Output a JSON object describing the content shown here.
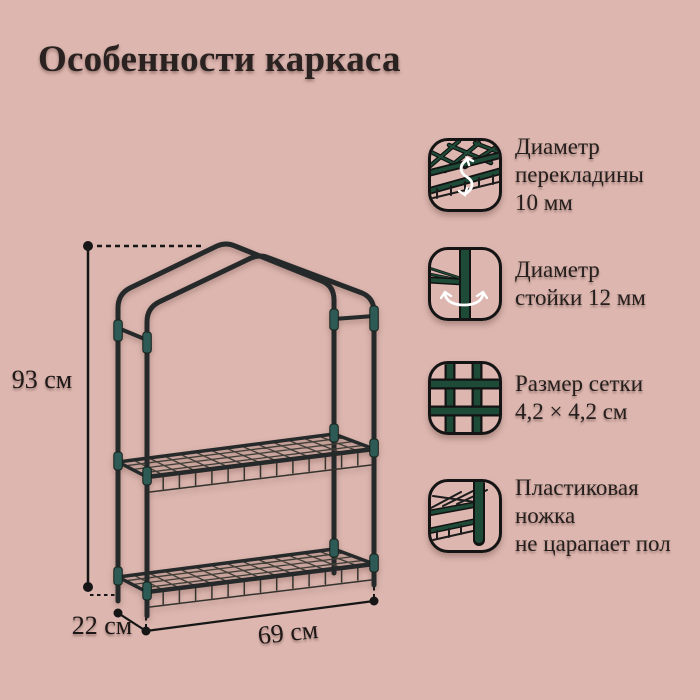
{
  "page": {
    "title": "Особенности каркаса",
    "background_color": "#dcb6af",
    "text_color": "#241e1c"
  },
  "diagram": {
    "height_label": "93 см",
    "depth_label": "22 см",
    "width_label": "69 см",
    "tube_color": "#26292a",
    "connector_color": "#2d5a54",
    "icon_green": "#1e4b37"
  },
  "features": [
    {
      "icon": "crossbar-diameter-icon",
      "text": "Диаметр\nперекладины\n10 мм"
    },
    {
      "icon": "post-diameter-icon",
      "text": "Диаметр\nстойки 12 мм"
    },
    {
      "icon": "mesh-size-icon",
      "text": "Размер сетки\n4,2 × 4,2 см"
    },
    {
      "icon": "plastic-foot-icon",
      "text": "Пластиковая\nножка\nне царапает пол"
    }
  ]
}
